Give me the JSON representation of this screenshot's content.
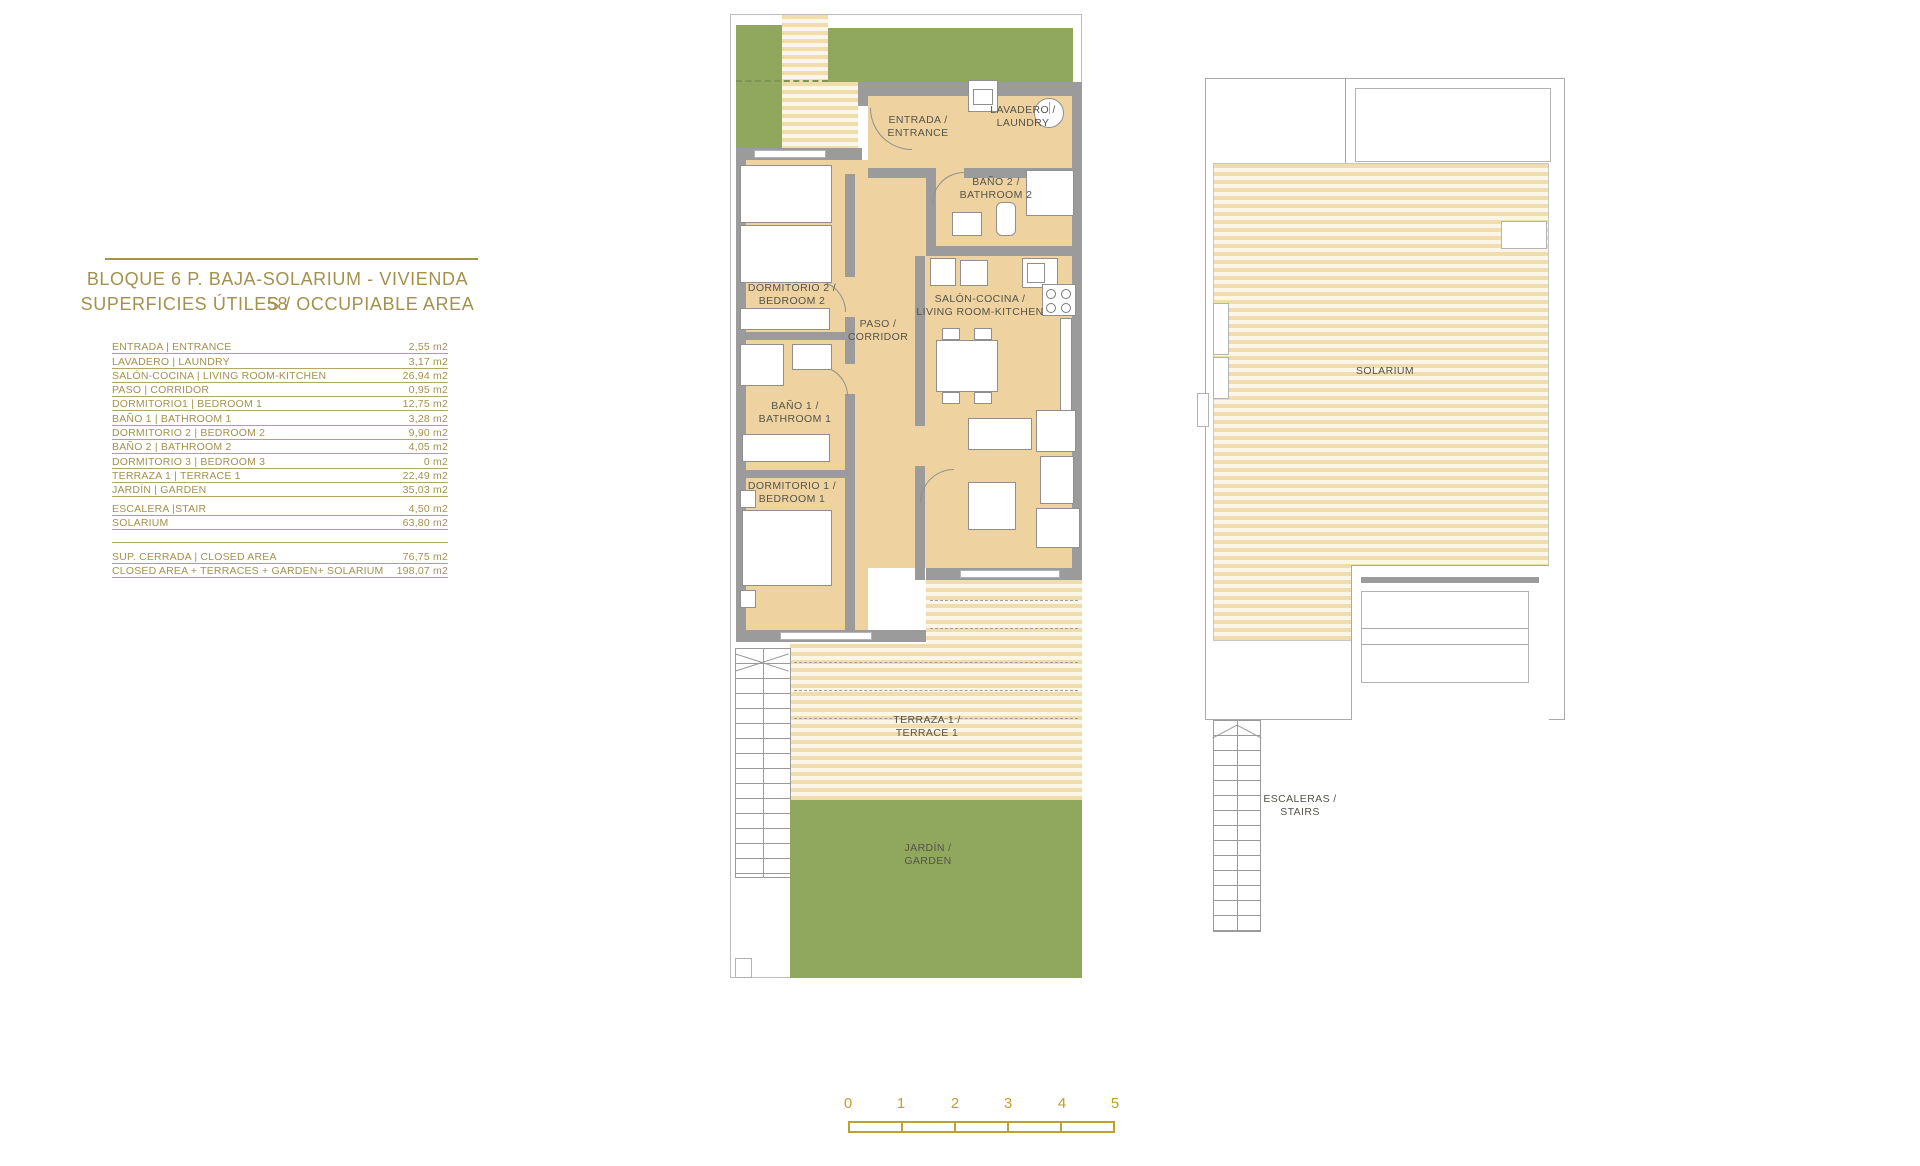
{
  "info_panel": {
    "title_line1": "BLOQUE 6 P. BAJA-SOLARIUM - VIVIENDA 58",
    "title_line2": "SUPERFICIES ÚTILES / OCCUPIABLE AREA",
    "unit_rows": [
      {
        "label": "ENTRADA | ENTRANCE",
        "value": "2,55 m2"
      },
      {
        "label": "LAVADERO | LAUNDRY",
        "value": "3,17 m2"
      },
      {
        "label": "SALÓN-COCINA | LIVING ROOM-KITCHEN",
        "value": "26,94 m2"
      },
      {
        "label": "PASO | CORRIDOR",
        "value": "0,95 m2"
      },
      {
        "label": "DORMITORIO1 | BEDROOM 1",
        "value": "12,75 m2"
      },
      {
        "label": "BAÑO 1 | BATHROOM 1",
        "value": "3,28 m2"
      },
      {
        "label": "DORMITORIO 2 | BEDROOM 2",
        "value": "9,90 m2"
      },
      {
        "label": "BAÑO 2 | BATHROOM 2",
        "value": "4,05 m2"
      },
      {
        "label": "DORMITORIO 3 | BEDROOM 3",
        "value": "0 m2"
      },
      {
        "label": "TERRAZA 1 | TERRACE 1",
        "value": "22,49 m2"
      },
      {
        "label": "JARDÍN | GARDEN",
        "value": "35,03 m2"
      },
      {
        "label": "ESCALERA |STAIR",
        "value": "4,50 m2"
      },
      {
        "label": "SOLARIUM",
        "value": "63,80 m2"
      }
    ],
    "summary_rows": [
      {
        "label": "SUP. CERRADA | CLOSED AREA",
        "value": "76,75 m2"
      },
      {
        "label": "CLOSED AREA + TERRACES + GARDEN+ SOLARIUM",
        "value": "198,07 m2"
      }
    ]
  },
  "ground_plan": {
    "rooms": {
      "entrada": "ENTRADA /\nENTRANCE",
      "lavadero": "LAVADERO /\nLAUNDRY",
      "bano2": "BAÑO 2 /\nBATHROOM 2",
      "dormitorio2": "DORMITORIO 2 /\nBEDROOM 2",
      "paso": "PASO /\nCORRIDOR",
      "salon": "SALÓN-COCINA /\nLIVING ROOM-KITCHEN",
      "bano1": "BAÑO 1 /\nBATHROOM 1",
      "dormitorio1": "DORMITORIO 1 /\nBEDROOM 1",
      "terraza1": "TERRAZA 1 /\nTERRACE 1",
      "jardin": "JARDÍN /\nGARDEN"
    }
  },
  "solarium_plan": {
    "rooms": {
      "solarium": "SOLARIUM",
      "escaleras": "ESCALERAS /\nSTAIRS"
    }
  },
  "scale_bar": {
    "labels": [
      "0",
      "1",
      "2",
      "3",
      "4",
      "5"
    ]
  },
  "colors": {
    "accent_gold": "#a3914d",
    "scale_gold": "#bda02f",
    "floor_tan": "#eed3a0",
    "stripe_tan": "#f0ddae",
    "garden_green": "#90a75e",
    "wall_gray": "#9b9b9b",
    "label_dark": "#55534a"
  }
}
